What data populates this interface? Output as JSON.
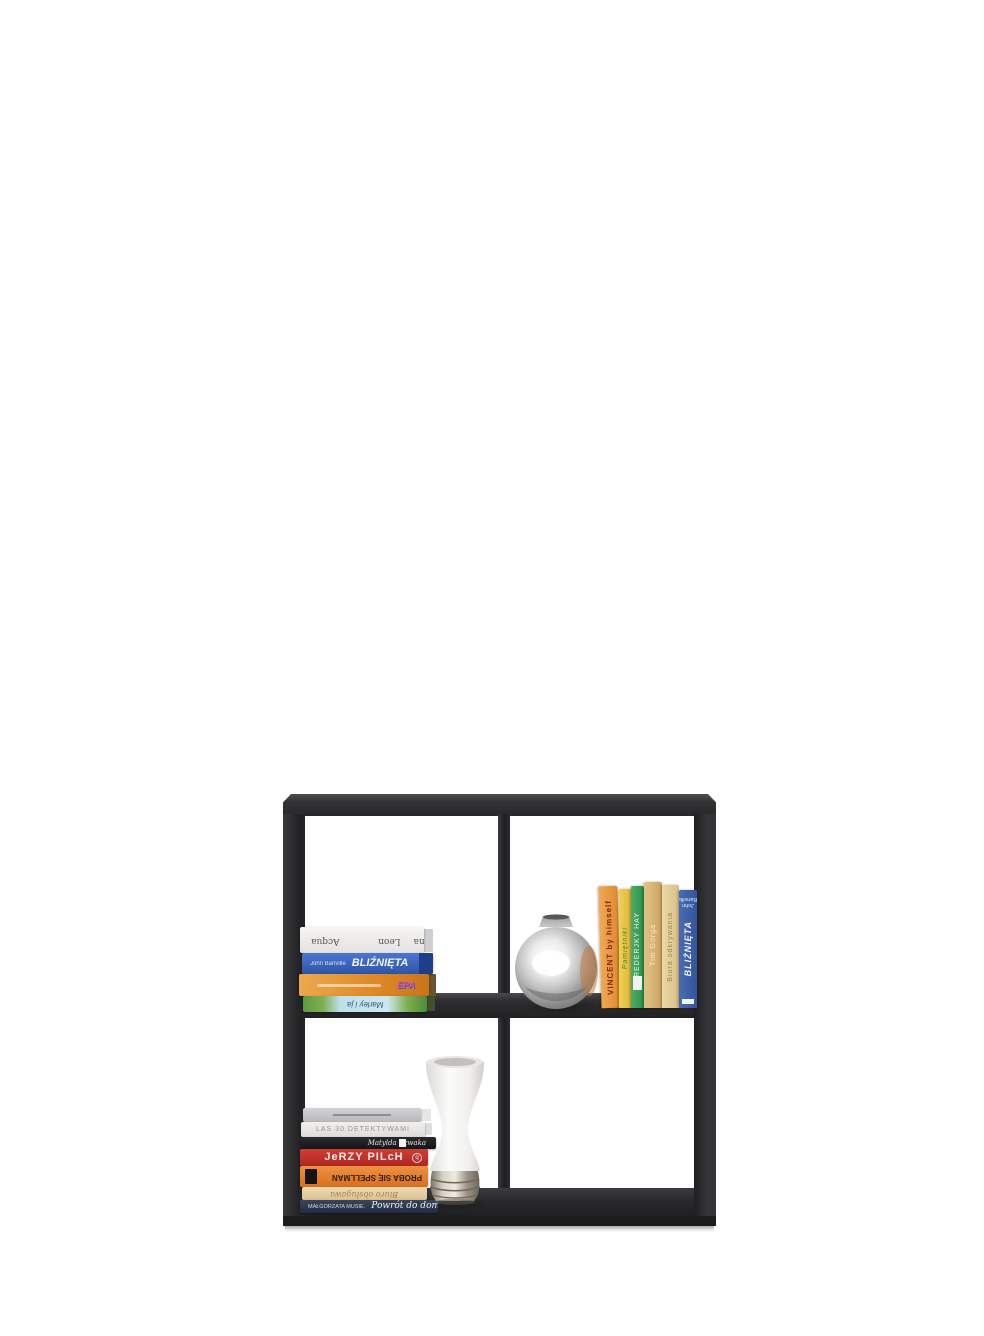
{
  "meta": {
    "description": "Product photo: black 2x2 cube bookcase with books and two vases on a white background",
    "background_color": "#ffffff"
  },
  "bookshelf": {
    "name": "2x2 cube bookcase",
    "frame_color": "#2b2b2d",
    "frame_highlight": "#4e4e50",
    "base_strip_color": "#eeeeee",
    "cells": [
      "top-left: stack of 4 books",
      "top-right: chrome vase and row of 6 books",
      "bottom-left: stack of 7 books and white vase",
      "bottom-right: empty"
    ]
  },
  "decor": {
    "silver_vase": {
      "label": "round chrome vase",
      "body_colors": [
        "#f8f8f8",
        "#bdbdbd",
        "#6e6e6e"
      ],
      "reflection_tint": "#c07a3e"
    },
    "white_vase": {
      "label": "white hourglass vase with chrome ribbed base",
      "body_color": "#f4f3f1",
      "base_color": "#9c9284"
    }
  },
  "books": {
    "top_left_stack": [
      {
        "author": "Donna Leon",
        "title": "Acqua alta",
        "flipped": true,
        "background": "linear-gradient(180deg,#f6f5f3,#e3e2e0)",
        "text_color": "#5a564f"
      },
      {
        "author": "John Banville",
        "title": "BLIŹNIĘTA",
        "flipped": false,
        "background": "linear-gradient(180deg,#4a76d0,#2e55a6)",
        "text_color": "#f2f4fa"
      },
      {
        "title": "",
        "logo_text": "EPA",
        "flipped": false,
        "background": "linear-gradient(100deg,#eda94e,#e08a28 55%,#c9731b)",
        "text_color": "#ffffff"
      },
      {
        "title": "Marley i ja",
        "flipped": true,
        "background": "linear-gradient(90deg,#5d9c3f,#7fae52 16%,#bfe0ea 30%,#cde8f0 68%,#7fae52 84%,#4d8c36)",
        "text_color": "#33597a"
      }
    ],
    "top_right_row": [
      {
        "title": "VINCENT by himself",
        "background": "linear-gradient(90deg,#f0a955,#e0892f)",
        "text_color": "#86270e"
      },
      {
        "title": "Pamiętniki",
        "background": "linear-gradient(90deg,#f0d052,#e0b83a)",
        "text_color": "#4a8a2e"
      },
      {
        "title": "FREDERJKY HAY",
        "background": "linear-gradient(90deg,#4cae66,#2e8f4a)",
        "text_color": "#f2f8f2"
      },
      {
        "title": "Tim Gorga",
        "background": "linear-gradient(90deg,#e2c488,#cda45e)",
        "text_color": "#f7ecd2"
      },
      {
        "title": "Biura odkrywania",
        "background": "linear-gradient(90deg,#ecd9a8,#d9bf85)",
        "text_color": "#a57f4a"
      },
      {
        "author": "John Banville",
        "title": "BLIŹNIĘTA",
        "background": "linear-gradient(90deg,#4a6cb4,#33549e)",
        "text_color": "#f2f4fa"
      }
    ],
    "bottom_left_stack": [
      {
        "title": "",
        "background": "linear-gradient(180deg,#d3d3d5,#b9b9bb)",
        "text_color": "#8e8e90"
      },
      {
        "title": "LAS 30 DETEKTYWAMI",
        "background": "linear-gradient(180deg,#f1f0ee,#dddcda)",
        "text_color": "#9a968e"
      },
      {
        "title": "Matylda Szwaka",
        "background": "linear-gradient(180deg,#2a2a2c,#161618)",
        "text_color": "#e6e6e6"
      },
      {
        "title": "JeRZY PILcH",
        "background": "linear-gradient(180deg,#d23c33,#b02721)",
        "text_color": "#f7eceb"
      },
      {
        "title": "PROBA SIĘ SPELLMAN",
        "flipped": true,
        "background": "linear-gradient(180deg,#ed9140,#d96f1d)",
        "text_color": "#2e1c08"
      },
      {
        "title": "Biuro obsługawa",
        "flipped": true,
        "background": "linear-gradient(180deg,#eedcb4,#dcc190)",
        "text_color": "#a5824e"
      },
      {
        "author": "MAŁGORZATA MUSIE.",
        "title": "Powrót do domu →",
        "background": "linear-gradient(180deg,#39455f,#222c42)",
        "text_color": "#eef0f4"
      }
    ]
  }
}
